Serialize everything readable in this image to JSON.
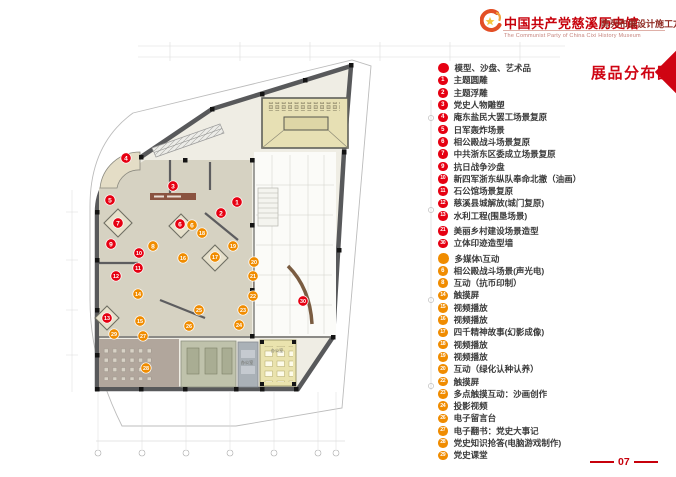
{
  "header": {
    "title_cn": "中国共产党慈溪历史馆",
    "subtitle_cn": "陈列布展设计施工方案",
    "title_en": "The Communist Party of China Cixi  History Museum"
  },
  "page": {
    "title": "展品分布图",
    "number": "07"
  },
  "colors": {
    "legend_red": "#e60012",
    "legend_orange": "#f08c00",
    "title_red": "#c7000b",
    "accent_red": "#cf0413"
  },
  "legend": {
    "sections": [
      {
        "header": "模型、沙盘、艺术品",
        "color": "#e60012",
        "items": [
          {
            "num": "1",
            "label": "主题圆雕"
          },
          {
            "num": "2",
            "label": "主题浮雕"
          },
          {
            "num": "3",
            "label": "党史人物雕塑"
          },
          {
            "num": "4",
            "label": "庵东盐民大罢工场景复原"
          },
          {
            "num": "5",
            "label": "日军轰炸场景"
          },
          {
            "num": "6",
            "label": "相公殿战斗场景复原"
          },
          {
            "num": "7",
            "label": "中共浙东区委成立场景复原"
          },
          {
            "num": "9",
            "label": "抗日战争沙盘"
          },
          {
            "num": "10",
            "label": "新四军浙东纵队奉命北撤（油画）"
          },
          {
            "num": "11",
            "label": "石公馆场景复原"
          },
          {
            "num": "12",
            "label": "慈溪县城解放(城门复原)"
          },
          {
            "num": "13",
            "label": "水利工程(围垦场景)"
          },
          {
            "num": "21",
            "label": "美丽乡村建设场景造型",
            "gap": true
          },
          {
            "num": "30",
            "label": "立体印迹造型墙"
          }
        ]
      },
      {
        "header": "多媒体\\互动",
        "color": "#f08c00",
        "gap": true,
        "items": [
          {
            "num": "6",
            "label": "相公殿战斗场景(声光电)"
          },
          {
            "num": "8",
            "label": "互动（抗币印制）"
          },
          {
            "num": "14",
            "label": "触摸屏"
          },
          {
            "num": "15",
            "label": "视频播放"
          },
          {
            "num": "16",
            "label": "视频播放"
          },
          {
            "num": "17",
            "label": "四千精神故事(幻影成像)"
          },
          {
            "num": "18",
            "label": "视频播放"
          },
          {
            "num": "19",
            "label": "视频播放"
          },
          {
            "num": "20",
            "label": "互动（绿化认种认养）"
          },
          {
            "num": "22",
            "label": "触摸屏"
          },
          {
            "num": "23",
            "label": "多点触摸互动：沙画创作"
          },
          {
            "num": "24",
            "label": "投影视频"
          },
          {
            "num": "26",
            "label": "电子留言台"
          },
          {
            "num": "27",
            "label": "电子翻书：党史大事记"
          },
          {
            "num": "28",
            "label": "党史知识抢答(电脑游戏制作)"
          },
          {
            "num": "29",
            "label": "党史课堂"
          }
        ]
      }
    ]
  },
  "plan": {
    "markers": [
      {
        "num": "4",
        "color": "#e60012",
        "x": 126,
        "y": 158
      },
      {
        "num": "3",
        "color": "#e60012",
        "x": 173,
        "y": 186
      },
      {
        "num": "5",
        "color": "#e60012",
        "x": 110,
        "y": 200
      },
      {
        "num": "1",
        "color": "#e60012",
        "x": 237,
        "y": 202
      },
      {
        "num": "2",
        "color": "#e60012",
        "x": 221,
        "y": 213
      },
      {
        "num": "6",
        "color": "#e60012",
        "x": 180,
        "y": 224
      },
      {
        "num": "7",
        "color": "#e60012",
        "x": 118,
        "y": 223
      },
      {
        "num": "9",
        "color": "#e60012",
        "x": 111,
        "y": 244
      },
      {
        "num": "10",
        "color": "#e60012",
        "x": 139,
        "y": 253
      },
      {
        "num": "11",
        "color": "#e60012",
        "x": 138,
        "y": 268
      },
      {
        "num": "12",
        "color": "#e60012",
        "x": 116,
        "y": 276
      },
      {
        "num": "13",
        "color": "#e60012",
        "x": 107,
        "y": 318
      },
      {
        "num": "30",
        "color": "#e60012",
        "x": 303,
        "y": 301
      },
      {
        "num": "6",
        "color": "#f08c00",
        "x": 192,
        "y": 225
      },
      {
        "num": "8",
        "color": "#f08c00",
        "x": 153,
        "y": 246
      },
      {
        "num": "18",
        "color": "#f08c00",
        "x": 202,
        "y": 233
      },
      {
        "num": "19",
        "color": "#f08c00",
        "x": 233,
        "y": 246
      },
      {
        "num": "16",
        "color": "#f08c00",
        "x": 183,
        "y": 258
      },
      {
        "num": "17",
        "color": "#f08c00",
        "x": 215,
        "y": 257
      },
      {
        "num": "20",
        "color": "#f08c00",
        "x": 254,
        "y": 262
      },
      {
        "num": "21",
        "color": "#f08c00",
        "x": 253,
        "y": 276
      },
      {
        "num": "14",
        "color": "#f08c00",
        "x": 138,
        "y": 294
      },
      {
        "num": "22",
        "color": "#f08c00",
        "x": 253,
        "y": 296
      },
      {
        "num": "25",
        "color": "#f08c00",
        "x": 199,
        "y": 310
      },
      {
        "num": "23",
        "color": "#f08c00",
        "x": 243,
        "y": 310
      },
      {
        "num": "15",
        "color": "#f08c00",
        "x": 140,
        "y": 321
      },
      {
        "num": "24",
        "color": "#f08c00",
        "x": 239,
        "y": 325
      },
      {
        "num": "26",
        "color": "#f08c00",
        "x": 189,
        "y": 326
      },
      {
        "num": "29",
        "color": "#f08c00",
        "x": 114,
        "y": 334
      },
      {
        "num": "27",
        "color": "#f08c00",
        "x": 143,
        "y": 336
      },
      {
        "num": "28",
        "color": "#f08c00",
        "x": 146,
        "y": 368
      }
    ],
    "room_labels": [
      {
        "text": "办公室",
        "x": 247,
        "y": 364
      },
      {
        "text": "办公室",
        "x": 277,
        "y": 352
      }
    ]
  }
}
